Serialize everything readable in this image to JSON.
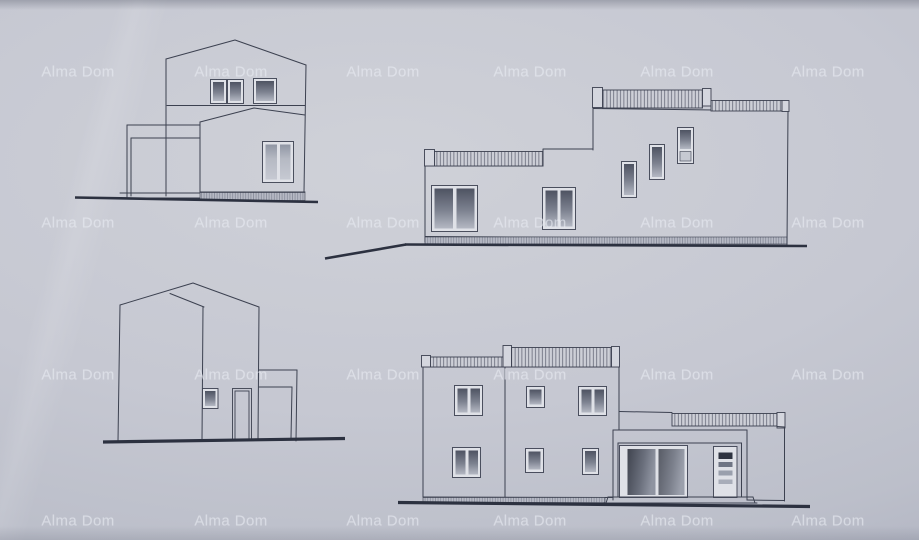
{
  "watermark": {
    "text": "Alma Dom",
    "columns_x": [
      78,
      231,
      383,
      530,
      677,
      828
    ],
    "rows_y": [
      72,
      223,
      375,
      521
    ]
  },
  "colors": {
    "paper": "#c6c8d2",
    "paper_light": "#cfd1d8",
    "paper_mid": "#bcbfca",
    "paper_dark": "#adb0bf",
    "line": "#3c4150",
    "thick": "#2c3140",
    "glass_dark": "#4e5362",
    "glass_light": "#aaaebb",
    "glass_soft_top": "#9096a4",
    "glass_soft_bottom": "#c2c5ce",
    "watermark": "#e9ecf3"
  },
  "drawing": {
    "views_count": 4
  }
}
